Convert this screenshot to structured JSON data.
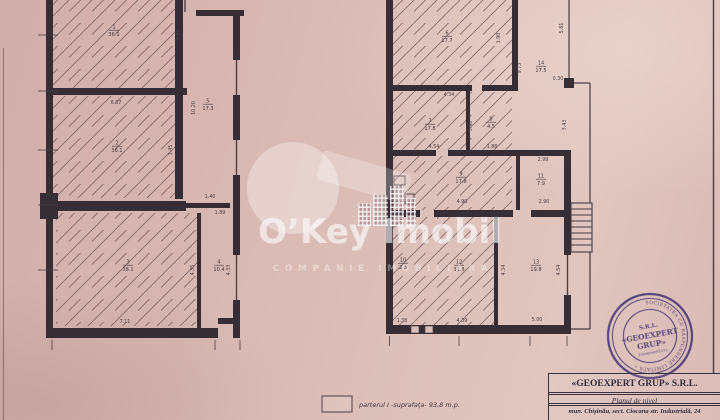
{
  "document": {
    "watermark": {
      "brand": "O’Key Imobil",
      "tagline": "COMPANIE IMOBILIARĂ"
    },
    "legend": {
      "note": "parterul I -suprafața- 93,8 m.p."
    },
    "title_block": {
      "company": "«GEOEXPERT GRUP» S.R.L.",
      "doc_title": "Planul de nivel",
      "address": "mun. Chișinău, sect. Ciocana str. Industrială, 24"
    },
    "stamp": {
      "line1": "S.R.L.",
      "line2": "«GEOEXPERT",
      "line3": "GRUP»",
      "reg_no": "1003600091273",
      "ring_text": "REPUBLICA MOLDOVA • MUN. CHIȘINĂU • SOCIETATEA CU RĂSPUNDERE LIMITATĂ •",
      "color": "#4a3f97"
    }
  },
  "plan": {
    "left_building": {
      "rooms": [
        {
          "num": "1",
          "area": "36.1"
        },
        {
          "num": "2",
          "area": "36.1"
        },
        {
          "num": "3",
          "area": "38.1"
        },
        {
          "num": "4",
          "area": "10.4"
        },
        {
          "num": "5",
          "area": "17.3"
        }
      ],
      "dims": [
        "6.37",
        "1.65",
        "10.20",
        "1.45",
        "1.40",
        "1.89",
        "7.11",
        "4.35",
        "4.33"
      ]
    },
    "right_building": {
      "rooms": [
        {
          "num": "6",
          "area": "17.7"
        },
        {
          "num": "7",
          "area": "17.8"
        },
        {
          "num": "8",
          "area": "4.5"
        },
        {
          "num": "9",
          "area": "17.8"
        },
        {
          "num": "10",
          "area": "2.3"
        },
        {
          "num": "11",
          "area": "7.9"
        },
        {
          "num": "12",
          "area": "31.8"
        },
        {
          "num": "13",
          "area": "19.8"
        },
        {
          "num": "14",
          "area": "17.5"
        }
      ],
      "dims": [
        "4.34",
        "1.90",
        "9.73",
        "5.81",
        "0.30",
        "4.54",
        "1.88",
        "3.90",
        "2.99",
        "3.43",
        "4.90",
        "2.90",
        "4.34",
        "4.54",
        "1.38",
        "4.39",
        "5.00"
      ]
    }
  }
}
